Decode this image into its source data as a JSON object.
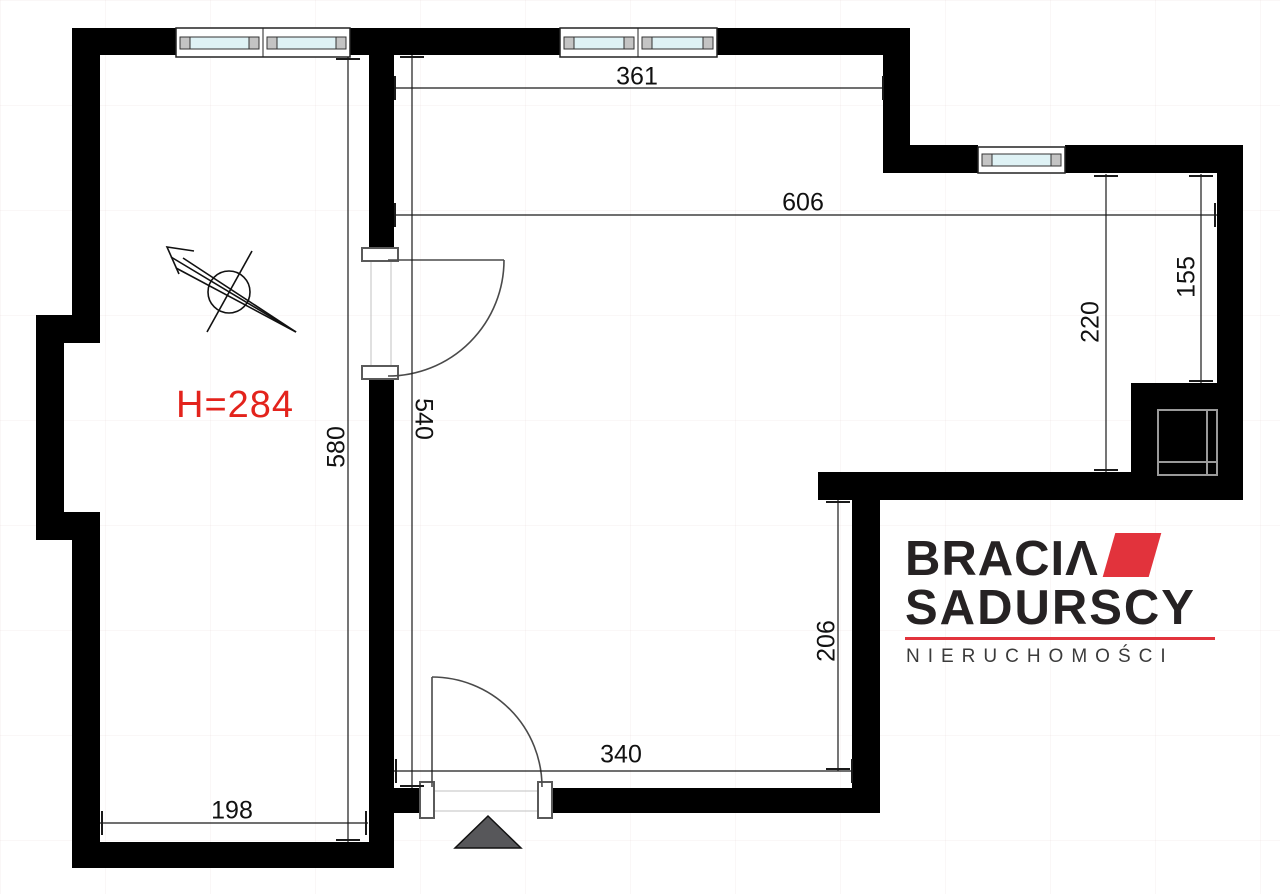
{
  "canvas": {
    "width": 1280,
    "height": 894,
    "background": "#ffffff"
  },
  "colors": {
    "wall": "#000000",
    "glass": "#dff2f5",
    "frame_block": "#c4c4c4",
    "door": "#4a4a4a",
    "dim": "#1a1a1a",
    "accent_red": "#e2333c",
    "height_red": "#e3231c",
    "triangle": "#57575a"
  },
  "labels": {
    "height": "H=284"
  },
  "dimensions": {
    "top_room_width": "361",
    "total_width": "606",
    "right_upper": "155",
    "right_inner": "220",
    "left_room_height": "580",
    "main_height": "540",
    "hall_right": "206",
    "hall_width": "340",
    "left_room_width": "198"
  },
  "logo": {
    "brand_top": "BRACIΛ",
    "brand_bottom": "SADURSCY",
    "tagline": "NIERUCHOMOŚCI"
  },
  "symbols": {
    "north_arrow": "compass-north-arrow",
    "entrance": "entrance-triangle",
    "shaft": "ventilation-shaft",
    "windows": "window-symbol",
    "doors": "door-swing-symbol"
  }
}
